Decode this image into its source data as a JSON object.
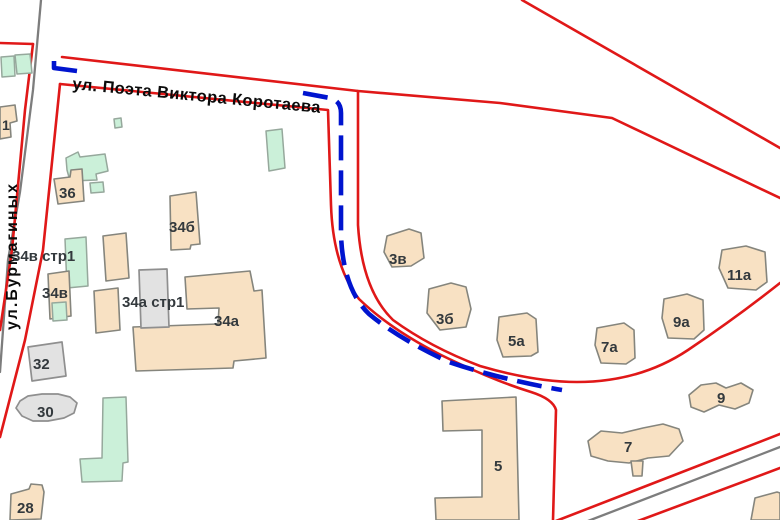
{
  "map": {
    "streets": {
      "korotaeva": "ул. Поэта Виктора Коротаева",
      "burmaginykh": "ул.Бурмагиных"
    },
    "building_labels": {
      "b1": "1",
      "b28": "28",
      "b30": "30",
      "b32": "32",
      "b36": "36",
      "b34a": "34а",
      "b34a_str1": "34а стр1",
      "b34b": "34б",
      "b34v": "34в",
      "b34v_str1": "34в стр1",
      "b3v": "3в",
      "b3b": "3б",
      "b5a": "5а",
      "b7a": "7а",
      "b9a": "9а",
      "b11a": "11а",
      "b5": "5",
      "b7": "7",
      "b9": "9"
    }
  },
  "colors": {
    "road": "#e01818",
    "route": "#0014cf",
    "centerline": "#7d7d7d",
    "building_beige": "#f8e1c3",
    "building_green": "#cbf0d9",
    "building_gray": "#e2e2e2",
    "outline": "#85857d",
    "label": "#33393d"
  }
}
